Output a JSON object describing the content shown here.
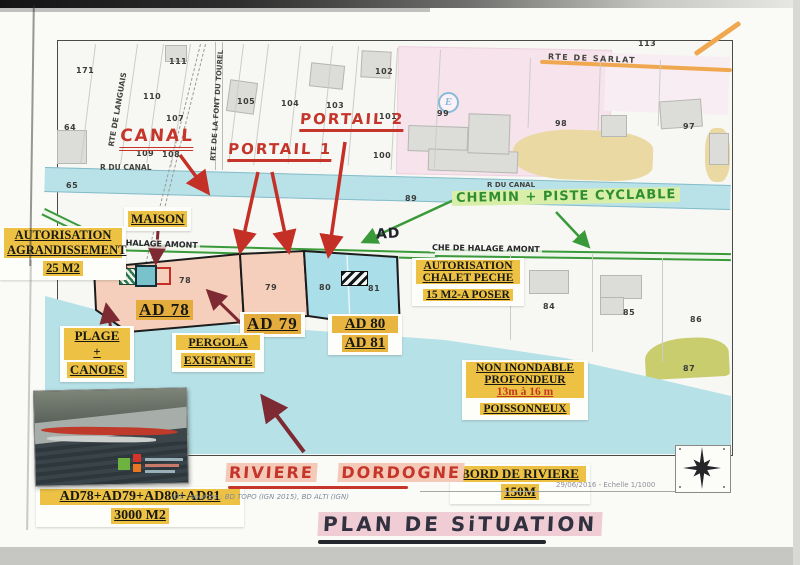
{
  "title": "PLAN DE SITUATION",
  "colors": {
    "water": "#b8e2e8",
    "parcel_pink": "#f5cfbb",
    "parcel_blue": "#aadee9",
    "highlight_yellow": "#edc244",
    "red_ink": "#c5352a",
    "green_ink": "#2f8f2f",
    "maroon_arrow": "#7e2a33",
    "road_orange": "#f0a850"
  },
  "map": {
    "e_badge": "E",
    "roads": {
      "rte_de_sarlat": "RTE DE SARLAT",
      "rte_de_languais": "RTE DE LANGUAIS",
      "rte_de_la_font_du_tourel": "RTE DE LA FONT DU TOUREL",
      "r_du_canal_left": "R DU CANAL",
      "r_du_canal_right": "R DU CANAL",
      "che_de_halage_left": "CHE DE HALAGE AMONT",
      "che_de_halage_right": "CHE DE HALAGE AMONT",
      "ad_path": "AD"
    },
    "parcel_numbers": [
      {
        "n": "171",
        "x": 76,
        "y": 66
      },
      {
        "n": "111",
        "x": 169,
        "y": 57
      },
      {
        "n": "110",
        "x": 143,
        "y": 92
      },
      {
        "n": "107",
        "x": 166,
        "y": 114
      },
      {
        "n": "64",
        "x": 64,
        "y": 123
      },
      {
        "n": "65",
        "x": 66,
        "y": 181
      },
      {
        "n": "105",
        "x": 237,
        "y": 97
      },
      {
        "n": "104",
        "x": 281,
        "y": 99
      },
      {
        "n": "103",
        "x": 326,
        "y": 101
      },
      {
        "n": "102",
        "x": 375,
        "y": 67
      },
      {
        "n": "101",
        "x": 379,
        "y": 112
      },
      {
        "n": "100",
        "x": 373,
        "y": 151
      },
      {
        "n": "99",
        "x": 437,
        "y": 109
      },
      {
        "n": "109",
        "x": 136,
        "y": 149
      },
      {
        "n": "108",
        "x": 162,
        "y": 150
      },
      {
        "n": "89",
        "x": 405,
        "y": 194
      },
      {
        "n": "113",
        "x": 638,
        "y": 39
      },
      {
        "n": "98",
        "x": 555,
        "y": 119
      },
      {
        "n": "97",
        "x": 683,
        "y": 122
      },
      {
        "n": "84",
        "x": 543,
        "y": 302
      },
      {
        "n": "85",
        "x": 623,
        "y": 308
      },
      {
        "n": "86",
        "x": 690,
        "y": 315
      },
      {
        "n": "87",
        "x": 683,
        "y": 364
      },
      {
        "n": "78",
        "x": 179,
        "y": 276
      },
      {
        "n": "79",
        "x": 265,
        "y": 283
      },
      {
        "n": "80",
        "x": 319,
        "y": 283
      },
      {
        "n": "81",
        "x": 368,
        "y": 284
      },
      {
        "n": "46",
        "x": 177,
        "y": 429
      }
    ]
  },
  "annotations": {
    "canal": "CANAL",
    "portail_1": "PORTAIL 1",
    "portail_2": "PORTAIL 2",
    "chemin_piste": "CHEMIN + PISTE CYCLABLE",
    "maison": "MAISON",
    "autorisation_agrandissement": [
      "AUTORISATION",
      "AGRANDISSEMENT",
      "25 M2"
    ],
    "autorisation_chalet": [
      "AUTORISATION",
      "CHALET PECHE",
      "15 M2-A POSER"
    ],
    "ad78": "AD 78",
    "ad79": "AD 79",
    "ad80_81": [
      "AD 80",
      "AD 81"
    ],
    "plage_canoes": [
      "PLAGE",
      "+",
      "CANOES"
    ],
    "pergola": [
      "PERGOLA",
      "EXISTANTE"
    ],
    "non_inondable": [
      "NON INONDABLE",
      "PROFONDEUR",
      "13m à 16 m",
      "POISSONNEUX"
    ],
    "riviere_dordogne_1": "RIVIERE",
    "riviere_dordogne_2": "DORDOGNE",
    "bord_de_riviere": [
      "BORD DE RIVIERE",
      "150M"
    ],
    "surface_totale": [
      "AD78+AD79+AD80+AD81",
      "3000 M2"
    ]
  },
  "footer": {
    "sources": "IDS - sources : BD TOPO (IGN 2015), BD ALTI (IGN)",
    "date_scale": "29/06/2016 - Echelle  1/1000",
    "plan_title": "PLAN DE SiTUATION"
  }
}
